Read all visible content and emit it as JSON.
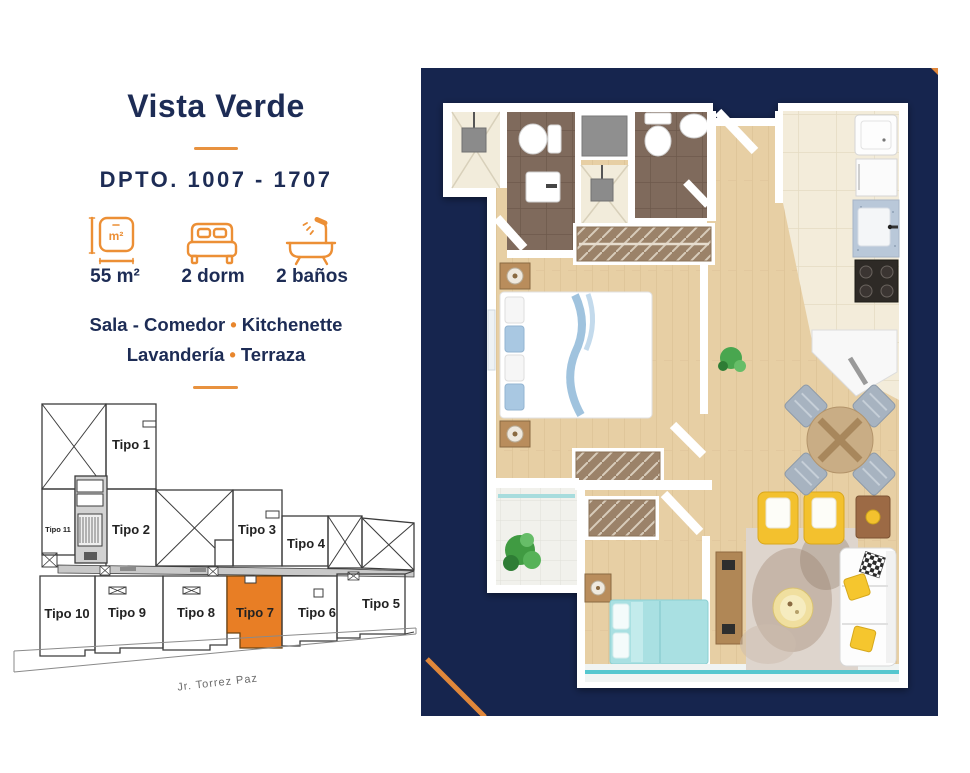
{
  "colors": {
    "navy_text": "#1d2c55",
    "panel_navy": "#16254e",
    "accent_orange": "#e8862d",
    "highlight_unit_orange": "#e87e25",
    "terrace_teal": "#57c7cf"
  },
  "header": {
    "title": "Vista Verde",
    "unit_label": "DPTO. 1007 - 1707"
  },
  "features": [
    {
      "icon": "area-icon",
      "icon_text": "m²",
      "value": "55 m²"
    },
    {
      "icon": "bed-icon",
      "value": "2 dorm"
    },
    {
      "icon": "bath-icon",
      "value": "2 baños"
    }
  ],
  "amenities": {
    "bullet": "•",
    "line1": [
      "Sala - Comedor",
      "Kitchenette"
    ],
    "line2": [
      "Lavandería",
      "Terraza"
    ]
  },
  "site_plan": {
    "street": "Jr. Torrez Paz",
    "highlighted_unit": "Tipo 7",
    "units": [
      "Tipo 1",
      "Tipo 2",
      "Tipo 3",
      "Tipo 4",
      "Tipo 5",
      "Tipo 6",
      "Tipo 7",
      "Tipo 8",
      "Tipo 9",
      "Tipo 10",
      "Tipo 11"
    ]
  }
}
